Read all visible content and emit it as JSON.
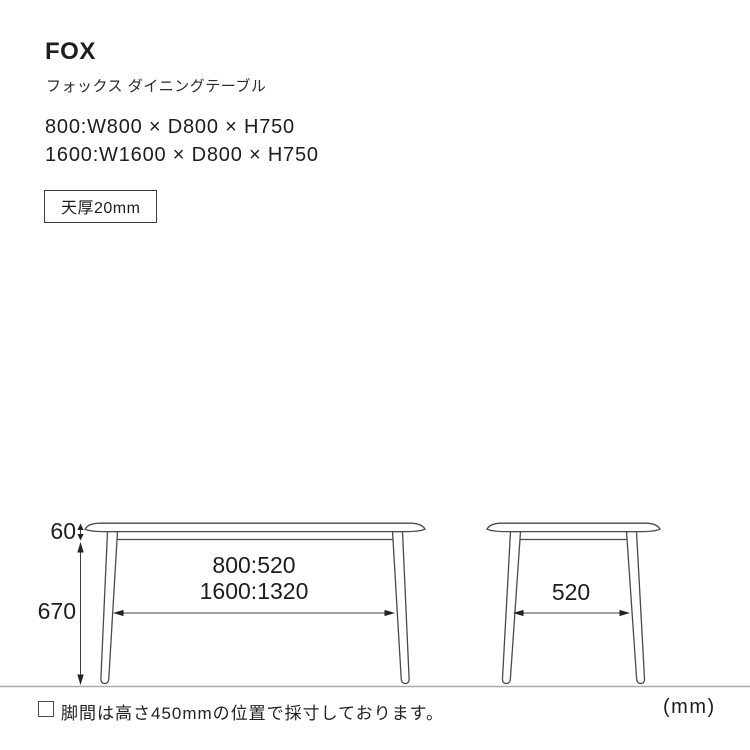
{
  "header": {
    "title": "FOX",
    "subtitle": "フォックス ダイニングテーブル",
    "sizes": [
      "800:W800 × D800 × H750",
      "1600:W1600 × D800 × H750"
    ],
    "thickness_badge": "天厚20mm"
  },
  "diagram": {
    "front_view": {
      "apron_height": "60",
      "leg_height": "670",
      "leg_span_line1": "800:520",
      "leg_span_line2": "1600:1320"
    },
    "side_view": {
      "leg_span": "520"
    },
    "unit_label": "(mm)",
    "line_color": "#4a4a4a",
    "ground_color": "#ababab"
  },
  "footer": {
    "note": "脚間は高さ450mmの位置で採寸しております。"
  }
}
